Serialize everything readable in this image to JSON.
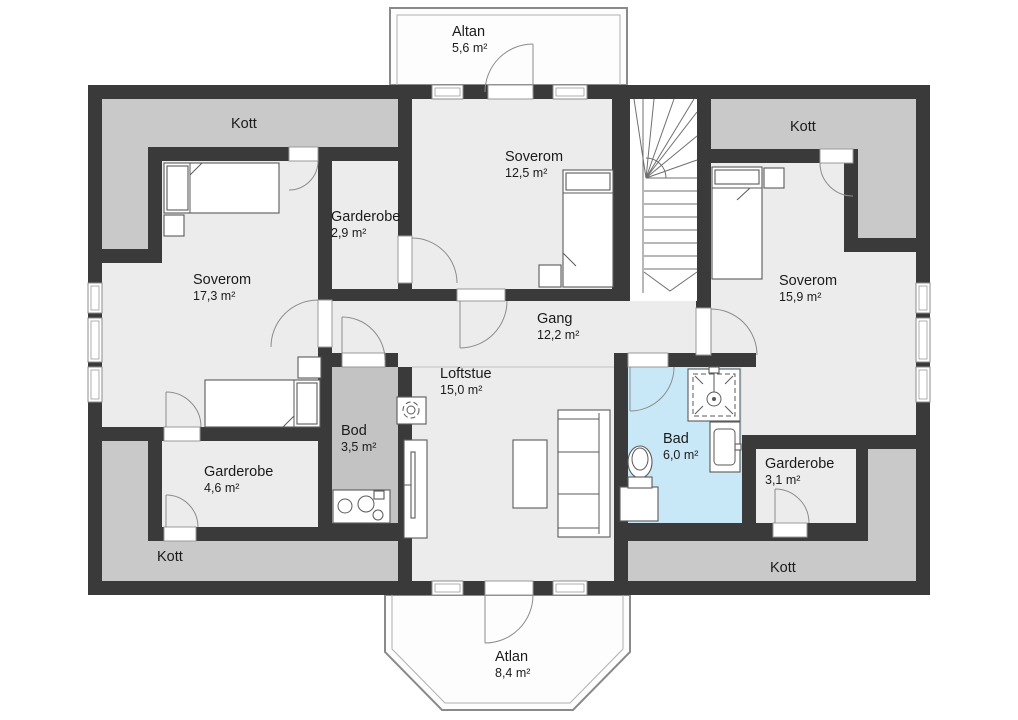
{
  "colors": {
    "wall": "#3a3a3a",
    "floor": "#ececec",
    "storage": "#c9c9c9",
    "bod": "#c3c3c3",
    "bath": "#c9e8f7"
  },
  "rooms": {
    "altan": {
      "name": "Altan",
      "area": "5,6 m²"
    },
    "kott_top_left": {
      "name": "Kott"
    },
    "soverom_12": {
      "name": "Soverom",
      "area": "12,5 m²"
    },
    "kott_top_right": {
      "name": "Kott"
    },
    "garderobe_29": {
      "name": "Garderobe",
      "area": "2,9 m²"
    },
    "soverom_17": {
      "name": "Soverom",
      "area": "17,3 m²"
    },
    "gang": {
      "name": "Gang",
      "area": "12,2 m²"
    },
    "soverom_15": {
      "name": "Soverom",
      "area": "15,9 m²"
    },
    "loftstue": {
      "name": "Loftstue",
      "area": "15,0 m²"
    },
    "bod": {
      "name": "Bod",
      "area": "3,5 m²"
    },
    "bad": {
      "name": "Bad",
      "area": "6,0 m²"
    },
    "garderobe_46": {
      "name": "Garderobe",
      "area": "4,6 m²"
    },
    "garderobe_31": {
      "name": "Garderobe",
      "area": "3,1 m²"
    },
    "kott_bottom_left": {
      "name": "Kott"
    },
    "kott_bottom_right": {
      "name": "Kott"
    },
    "atlan": {
      "name": "Atlan",
      "area": "8,4 m²"
    }
  }
}
